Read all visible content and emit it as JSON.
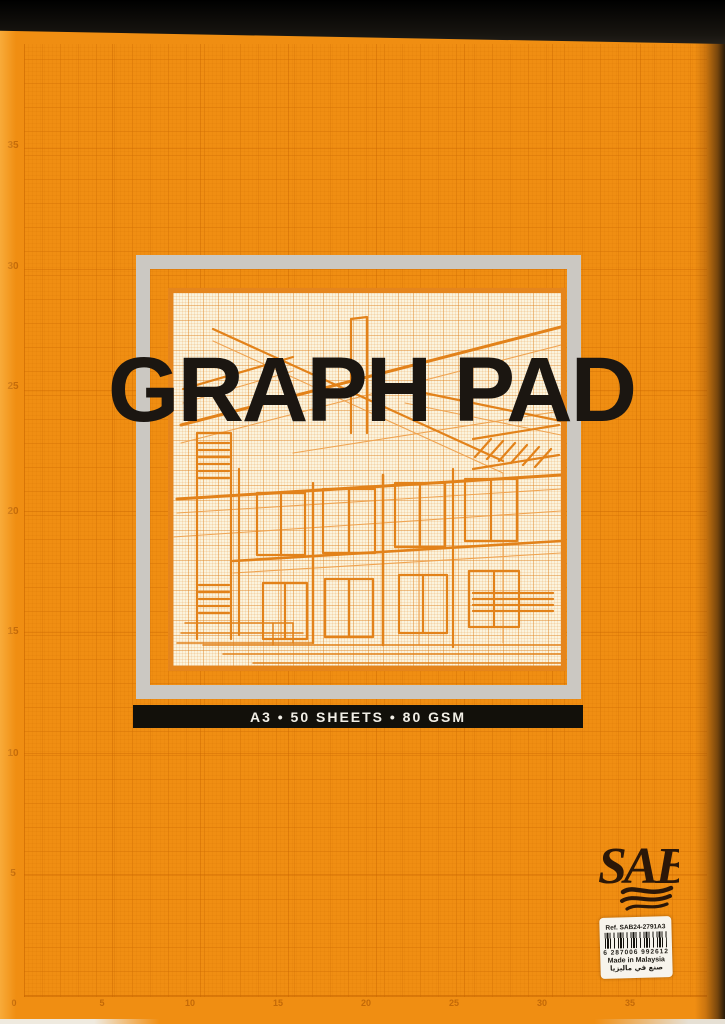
{
  "cover": {
    "title": "GRAPH PAD",
    "spec": "A3 • 50 SHEETS • 80 GSM",
    "brand": "SAB"
  },
  "label": {
    "ref": "Ref. SAB24-2791A3",
    "barcode_digits": "6 287006 992612",
    "made_in": "Made in Malaysia",
    "arabic": "صنع في ماليزيا"
  },
  "ruler": {
    "left_values": [
      "35",
      "30",
      "25",
      "20",
      "15",
      "10",
      "5"
    ],
    "bottom_values": [
      "0",
      "5",
      "10",
      "15",
      "20",
      "25",
      "30",
      "35"
    ]
  },
  "colors": {
    "cover_orange": "#F08E12",
    "frame_gray": "#CBC8C2",
    "paper_cream": "#FBF4DE",
    "drawing_orange": "#E2821A",
    "bar_black": "#12100A",
    "title_black": "#1B1611",
    "label_white": "#F7F4EC"
  }
}
